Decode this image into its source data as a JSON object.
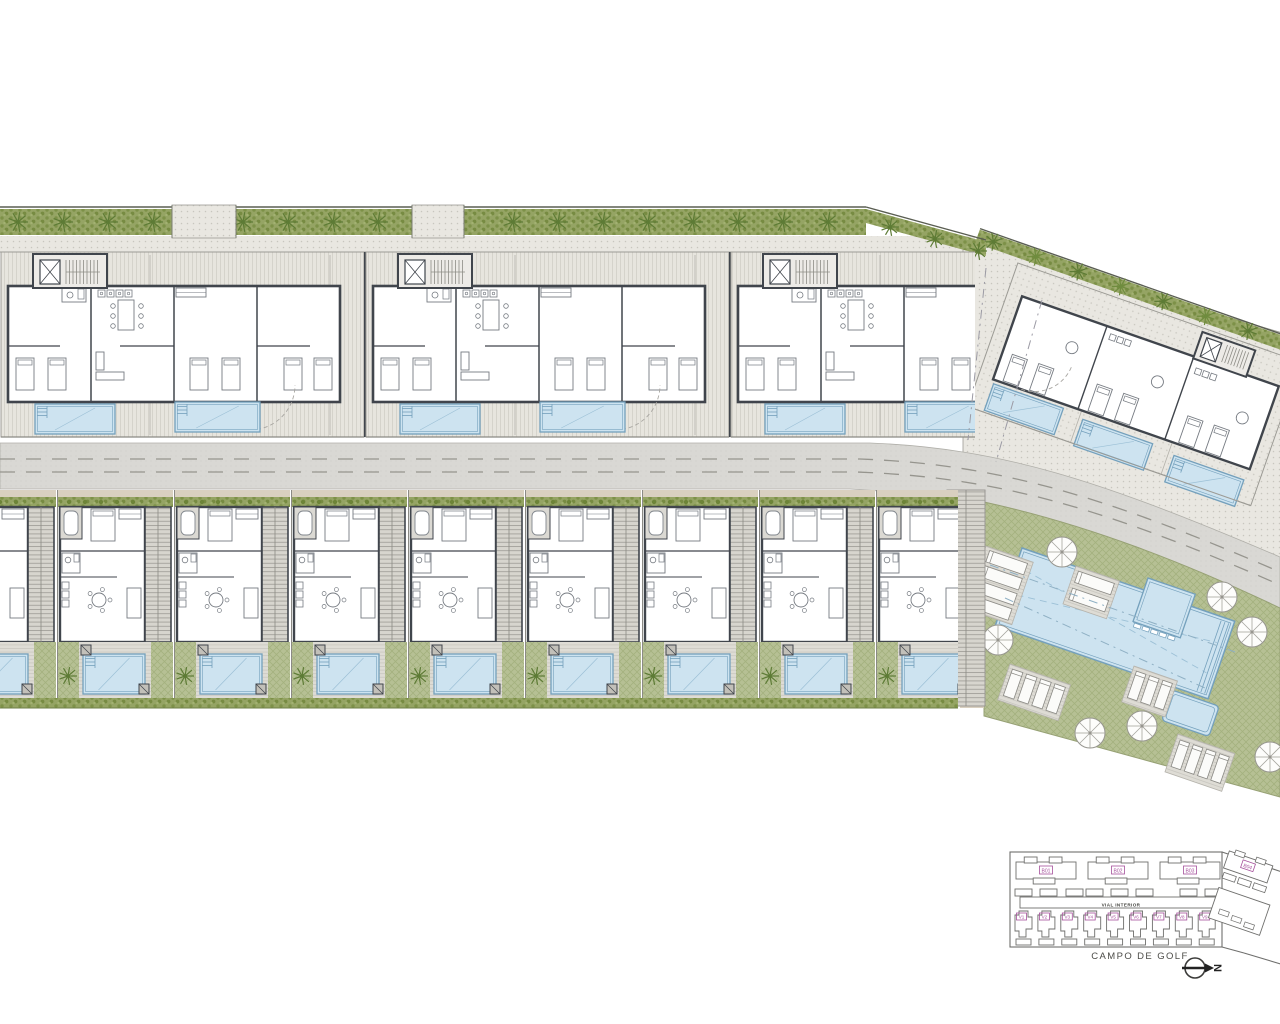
{
  "keyplan": {
    "blocks": [
      "B01",
      "B02",
      "B03"
    ],
    "right_block_label": "B04",
    "villas": [
      "V1",
      "V2",
      "V3",
      "V4",
      "V5",
      "V6",
      "V7",
      "V8",
      "V9"
    ],
    "road_label": "VIAL INTERIOR",
    "pool_area_label": "PISCINA",
    "golf_label": "CAMPO DE GOLF",
    "north_label": "N"
  },
  "site": {
    "top_buildings": 3,
    "pools_per_top_building": 2,
    "bottom_villas": 9,
    "right_block_pools": 3,
    "communal_umbrellas": 7,
    "lounger_decks": 5
  },
  "colors": {
    "wall": "#40454c",
    "furniture": "#767b82",
    "line": "#9c9b95",
    "pool": "#cde3f0",
    "pool_edge": "#74a0bc",
    "pool_ripple": "#9cc0d6",
    "hedge_dark": "#6d8438",
    "tree": "#5d7b35",
    "tree_alt": "#6f8c3e",
    "lawn_line": "#a4b17f",
    "road_dash": "#96958e",
    "fence": "#5a5e52",
    "tan": "#d9d0c0",
    "keyplan_line": "#6f6f6d",
    "magenta": "#a6519c",
    "guide": "#9b9aa4"
  }
}
